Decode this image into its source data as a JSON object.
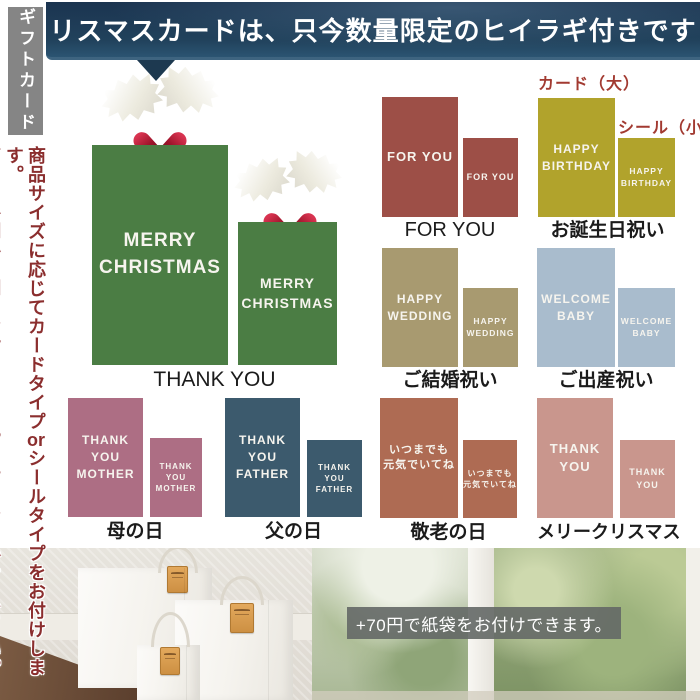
{
  "banner": {
    "text": "クリスマスカードは、只今数量限定のヒイラギ付きです！"
  },
  "sidebar": {
    "tab": "ギフトカード",
    "note1_pre": "商品サイズに応じてカードタイプ",
    "note1_or": "or",
    "note1_post": "シールタイプをお付けします。",
    "note2": "商品の外側か内側にお付けします。当店におまかせください。"
  },
  "annotations": {
    "card_large": "カード（大）",
    "seal_small": "シール（小）"
  },
  "groups": [
    {
      "id": "thankyou-holiday",
      "label": "THANK YOU",
      "lines": [
        "MERRY",
        "CHRISTMAS"
      ]
    },
    {
      "id": "foryou",
      "label": "FOR YOU",
      "lines": [
        "FOR YOU"
      ]
    },
    {
      "id": "birthday",
      "label": "お誕生日祝い",
      "lines": [
        "HAPPY",
        "BIRTHDAY"
      ]
    },
    {
      "id": "wedding",
      "label": "ご結婚祝い",
      "lines": [
        "HAPPY",
        "WEDDING"
      ]
    },
    {
      "id": "baby",
      "label": "ご出産祝い",
      "lines": [
        "WELCOME",
        "BABY"
      ]
    },
    {
      "id": "mother",
      "label": "母の日",
      "lines": [
        "THANK YOU",
        "MOTHER"
      ]
    },
    {
      "id": "father",
      "label": "父の日",
      "lines": [
        "THANK YOU",
        "FATHER"
      ]
    },
    {
      "id": "keirou",
      "label": "敬老の日",
      "lines": [
        "いつまでも",
        "元気でいてね"
      ]
    },
    {
      "id": "merry-christmas",
      "label": "メリークリスマス",
      "lines": [
        "THANK YOU"
      ]
    }
  ],
  "photo": {
    "caption": "+70円で紙袋をお付けできます。"
  },
  "colors": {
    "banner_navy": "#1e3a52",
    "tab_gray": "#858585",
    "note_red": "#8b2e2e",
    "annotation_red": "#a23a31",
    "green": "#4b7d44",
    "foryou": "#9d4f47",
    "birthday": "#b1a32c",
    "wedding": "#a89a70",
    "baby": "#a9bccd",
    "mother": "#ad6e84",
    "father": "#3c5a6d",
    "keirou": "#ae6b53",
    "merryxmas": "#c9968d"
  }
}
